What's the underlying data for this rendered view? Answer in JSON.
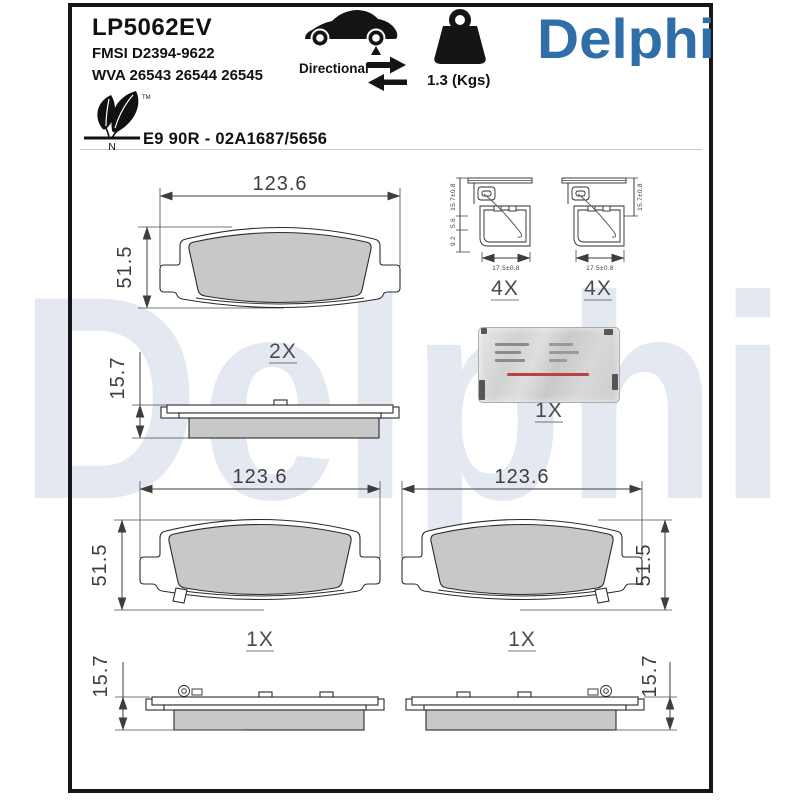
{
  "header": {
    "part_number": "LP5062EV",
    "fmsi": "FMSI D2394-9622",
    "wva": "WVA 26543 26544 26545",
    "directional": "Directional",
    "weight": "1.3 (Kgs)",
    "brand": "Delphi",
    "approval": "E9 90R - 02A1687/5656",
    "eco_letter": "N",
    "eco_tm": "TM"
  },
  "watermark": "Delphi",
  "dimensions": {
    "pad_width": "123.6",
    "pad_height": "51.5",
    "pad_thickness": "15.7",
    "clip_width": "17.5±0.8",
    "clip_height": "15.7±0.8",
    "clip_seg_a": "5.6",
    "clip_seg_b": "9.2"
  },
  "quantities": {
    "top_pad_pair": "2X",
    "hardware_clips": "4X",
    "grease_sachet": "1X",
    "bottom_left_pad": "1X",
    "bottom_right_pad": "1X"
  },
  "colors": {
    "brand_blue": "#2F6EA9",
    "watermark_blue": "#E4E9F1",
    "friction_gray": "#C8C8C8"
  }
}
